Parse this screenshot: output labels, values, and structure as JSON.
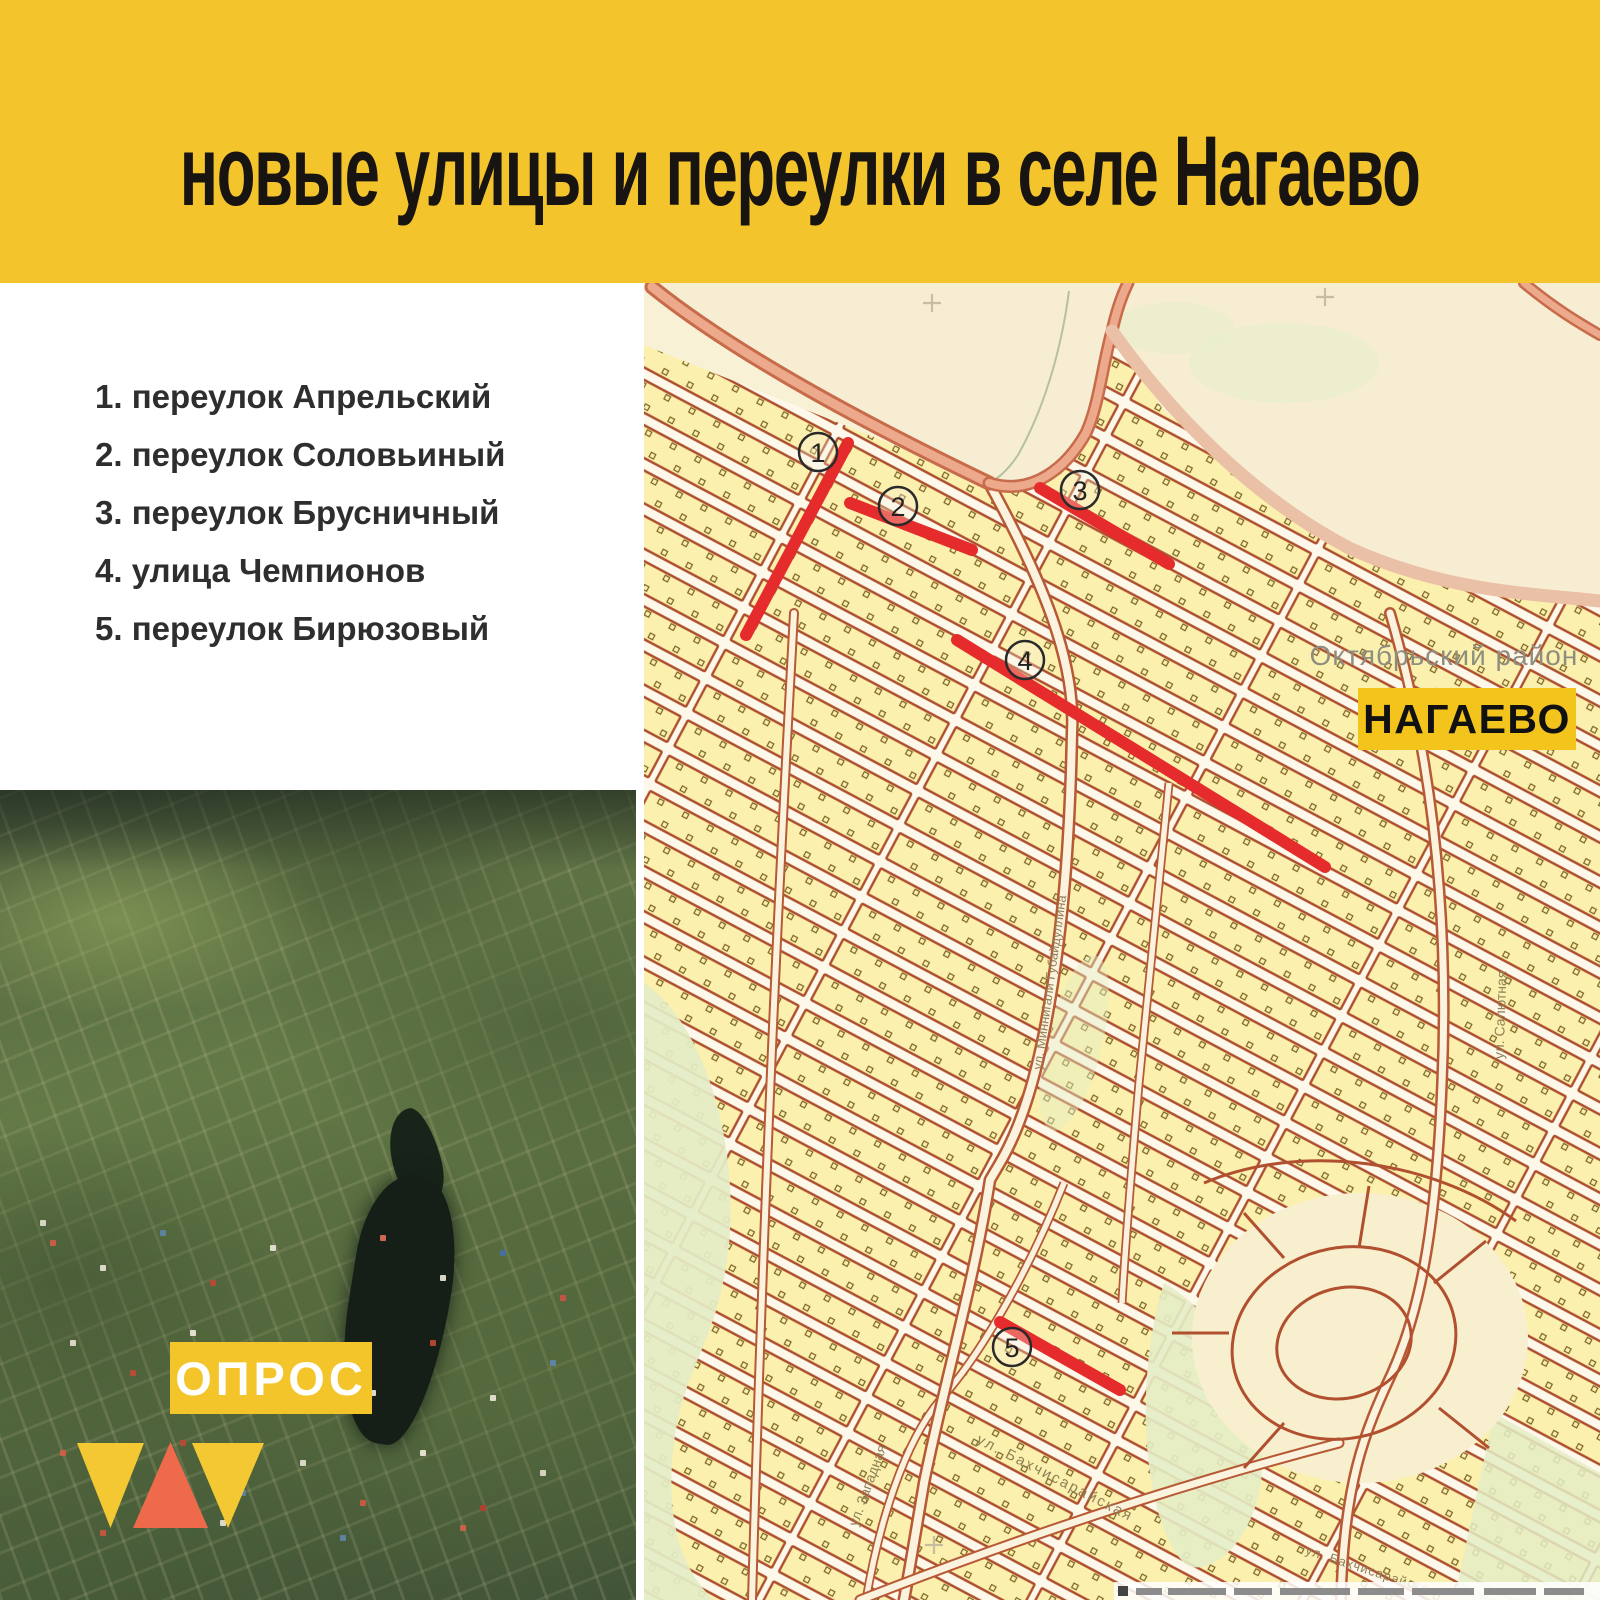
{
  "header": {
    "title": "новые улицы и переулки в селе Нагаево",
    "bg_color": "#f4c42c"
  },
  "legend": {
    "items": [
      "1. переулок Апрельский",
      "2. переулок Соловьиный",
      "3. переулок Брусничный",
      "4. улица Чемпионов",
      "5. переулок Бирюзовый"
    ]
  },
  "map": {
    "region_label": "Октябрьский район",
    "village_badge": "НАГАЕВО",
    "markers": [
      "1",
      "2",
      "3",
      "4",
      "5"
    ],
    "street_labels": {
      "gubaidullina": "ул. Миннигали Губайдуллина",
      "salutnaya": "ул. Салютная",
      "zapadnaya": "ул. Западная",
      "bakhchisarayskaya": "ул. Бахчисарайская",
      "bakhchisarayskaya2": "ул. Бахчисарайская"
    },
    "colors": {
      "highlight_red": "#e52b2b",
      "block_fill": "#fcf0ae",
      "block_outline": "#ad4f2e",
      "road_salmon": "#eda98c",
      "map_background": "#f9f1d6",
      "village_badge_bg": "#f3c41c"
    }
  },
  "photo": {
    "badge": "ОПРОС",
    "colors": {
      "badge_bg": "#f4c52b",
      "triangle_yellow": "#f4c832",
      "triangle_orange": "#ee6a4b"
    }
  }
}
